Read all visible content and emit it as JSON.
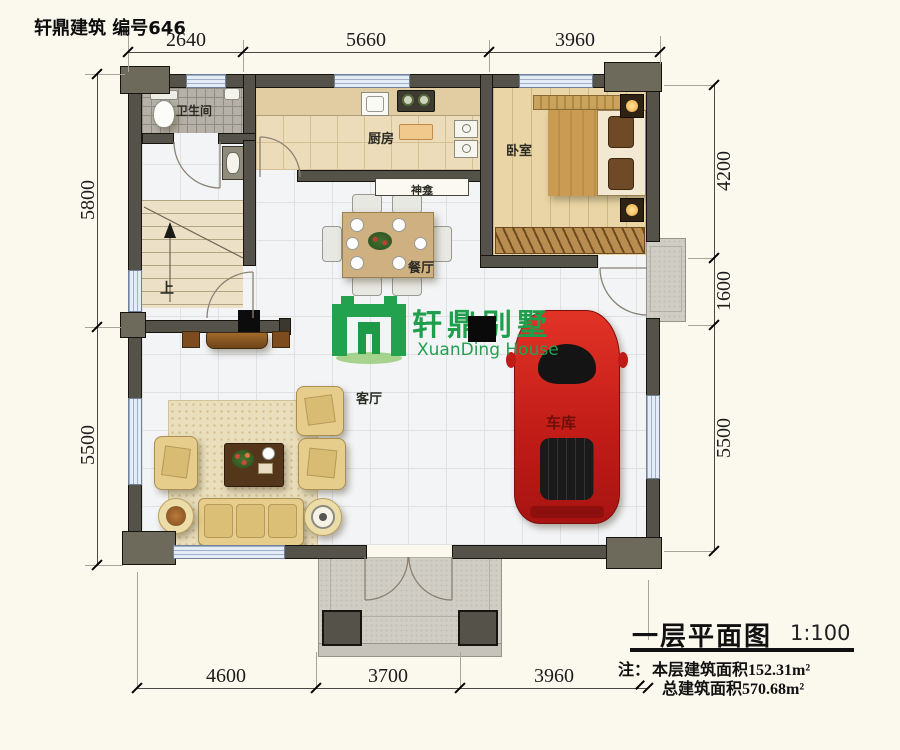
{
  "title": "轩鼎建筑 编号646",
  "logo": {
    "cn": "轩鼎别墅",
    "en": "XuanDing House"
  },
  "rooms": {
    "bathroom": "卫生间",
    "kitchen": "厨房",
    "bedroom": "卧室",
    "shrine": "神龛",
    "dining": "餐厅",
    "living": "客厅",
    "garage": "车库",
    "stairs_up": "上"
  },
  "dims": {
    "top": [
      "2640",
      "5660",
      "3960"
    ],
    "left": [
      "5800",
      "5500"
    ],
    "right": [
      "4200",
      "1600",
      "5500"
    ],
    "bottom": [
      "4600",
      "3700",
      "3960"
    ]
  },
  "footer": {
    "plan_name": "一层平面图",
    "scale": "1:100",
    "note_label": "注：",
    "note_line1": "本层建筑面积152.31m²",
    "note_line2": "总建筑面积570.68m²"
  },
  "colors": {
    "wall": "#55524a",
    "window": "#e4ecf7",
    "logo_green": "#1f9e4c",
    "car_red": "#cf1f1e",
    "marble_floor": "#f3f4f6",
    "wood_floor": "#e9d5a5",
    "kitchen_floor": "#ecdcba",
    "sofa": "#e6cd8c",
    "background": "#fbf8ee"
  }
}
